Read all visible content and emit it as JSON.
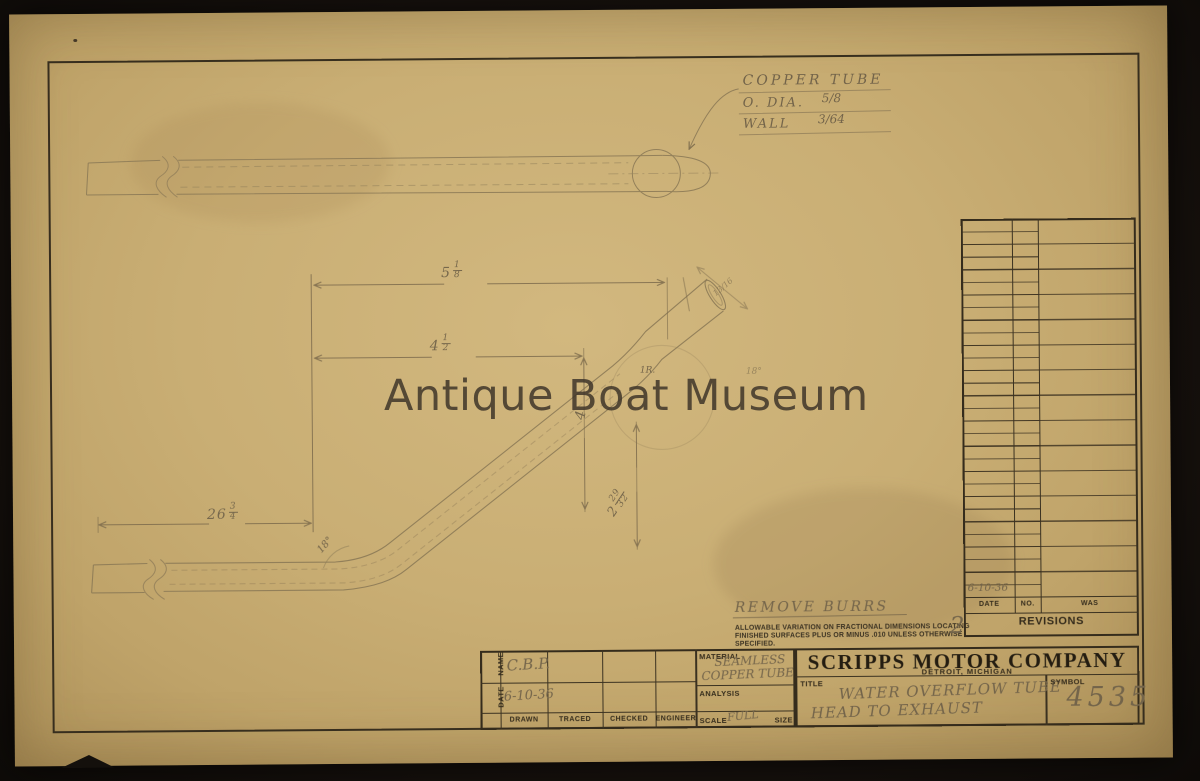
{
  "watermark": {
    "text": "Antique Boat Museum"
  },
  "callout": {
    "title": "COPPER TUBE",
    "od_label": "O. DIA.",
    "od_value": "5/8",
    "wall_label": "WALL",
    "wall_value": "3/64"
  },
  "dims": {
    "top": {
      "whole": "5",
      "num": "1",
      "den": "8"
    },
    "mid": {
      "whole": "4",
      "num": "1",
      "den": "2"
    },
    "vert": {
      "whole": "4"
    },
    "diag": {
      "whole": "2",
      "num": "29",
      "den": "32"
    },
    "left": {
      "whole": "26",
      "num": "3",
      "den": "4"
    },
    "angle_lower": "18°",
    "angle_upper": "18°",
    "radius": "1R.",
    "stub": "13/16"
  },
  "notes": {
    "remove_burrs": "REMOVE BURRS",
    "tol1": "ALLOWABLE VARIATION ON FRACTIONAL DIMENSIONS LOCATING",
    "tol2": "FINISHED SURFACES PLUS OR MINUS .010 UNLESS OTHERWISE",
    "tol3": "SPECIFIED.",
    "sheet_no": "2"
  },
  "revisions": {
    "entry_date": "6-10-36",
    "date_label": "DATE",
    "no_label": "NO.",
    "was_label": "WAS",
    "title": "REVISIONS"
  },
  "title_block": {
    "name_label": "NAME",
    "date_label": "DATE",
    "name_value": "C.B.P.",
    "date_value": "6-10-36",
    "columns": [
      "DRAWN",
      "TRACED",
      "CHECKED",
      "ENGINEER"
    ],
    "material_label": "MATERIAL",
    "material_line1": "SEAMLESS",
    "material_line2": "COPPER TUBE",
    "analysis_label": "ANALYSIS",
    "scale_label": "SCALE",
    "scale_value": "FULL",
    "size_label": "SIZE",
    "company": "SCRIPPS MOTOR COMPANY",
    "location": "DETROIT, MICHIGAN",
    "title_label": "TITLE",
    "title_line1": "WATER OVERFLOW TUBE",
    "title_line2": "HEAD TO EXHAUST",
    "symbol_label": "SYMBOL",
    "symbol_value": "4535"
  }
}
